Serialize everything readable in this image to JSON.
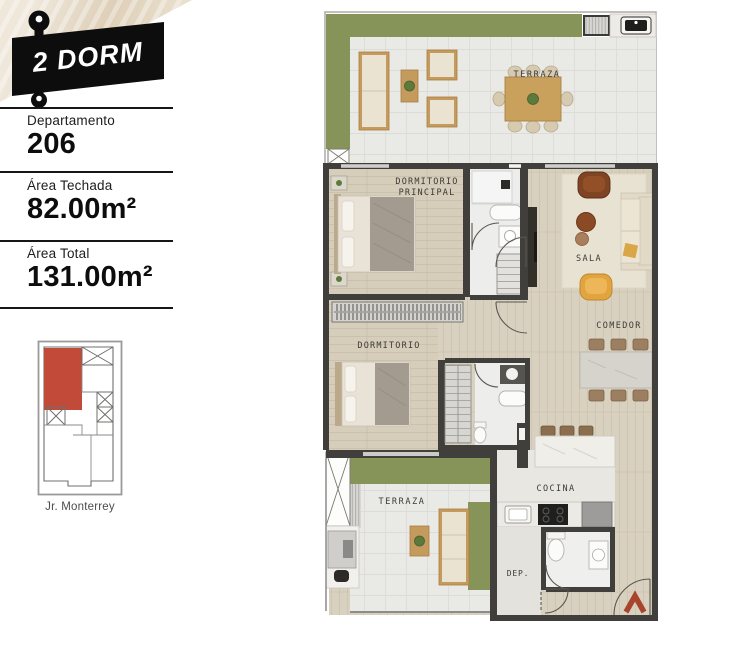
{
  "sidebar": {
    "badge_label": "2 DORM",
    "sections": [
      {
        "label": "Departamento",
        "value": "206"
      },
      {
        "label": "Área Techada",
        "value": "82.00m²"
      },
      {
        "label": "Área Total",
        "value": "131.00m²"
      }
    ],
    "keyplan": {
      "street_label": "Jr. Monterrey"
    }
  },
  "plan": {
    "labels": {
      "terraza_top": "TERRAZA",
      "dormitorio_principal_line1": "DORMITORIO",
      "dormitorio_principal_line2": "PRINCIPAL",
      "sala": "SALA",
      "comedor": "COMEDOR",
      "dormitorio": "DORMITORIO",
      "terraza_bottom": "TERRAZA",
      "cocina": "COCINA",
      "deposito": "DEP."
    }
  },
  "colors": {
    "accent_red": "#c14b38",
    "badge_black": "#0d0d0d",
    "grass_green": "#879459",
    "wall_dark": "#403f3c",
    "entrance_arrow": "#a8432c"
  }
}
